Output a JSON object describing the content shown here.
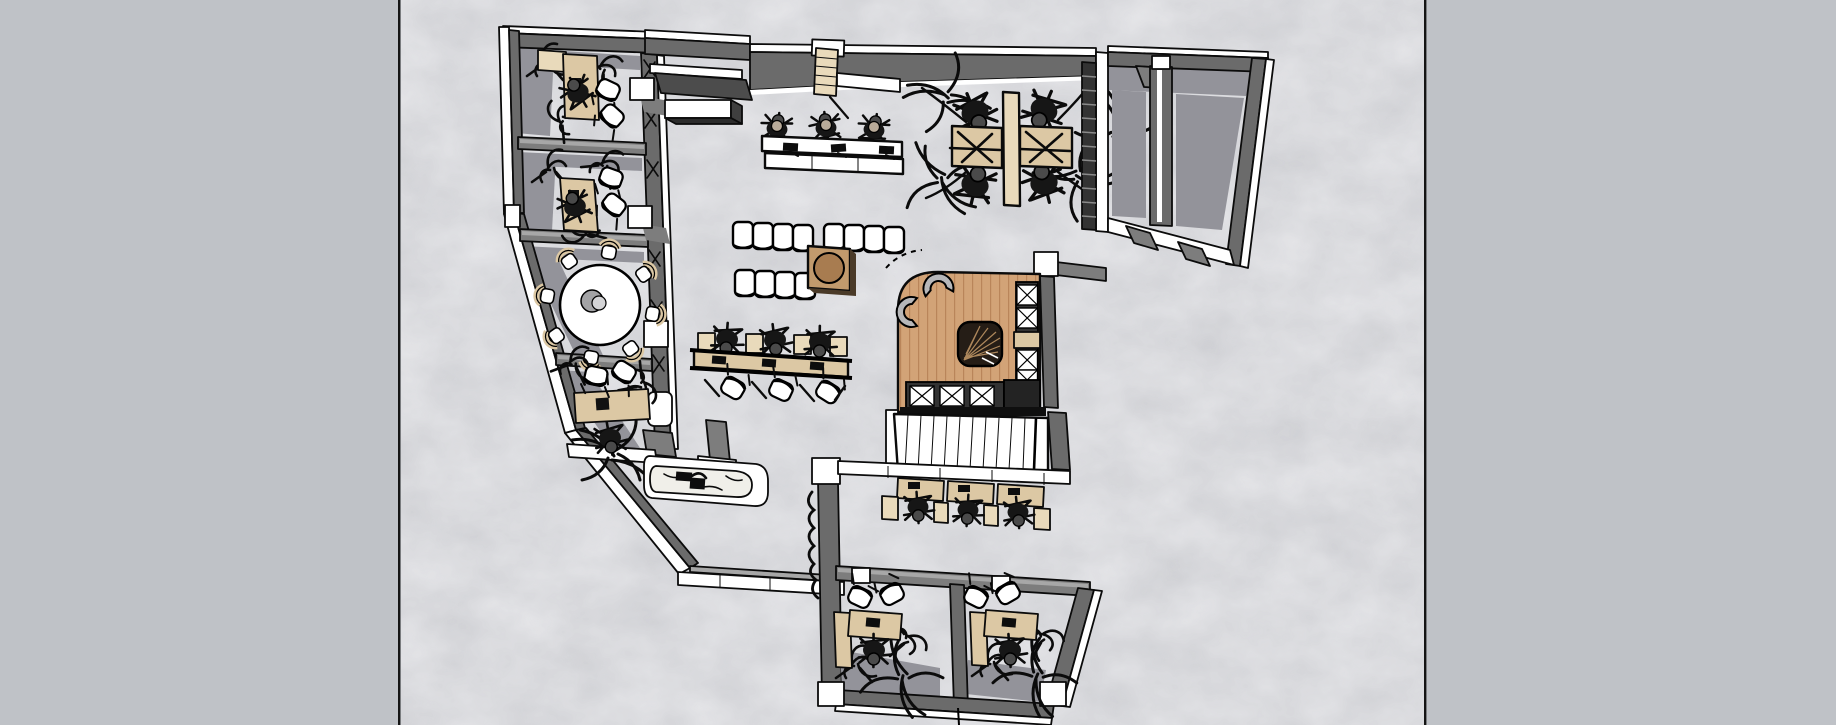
{
  "view": {
    "kind": "architectural-floor-plan",
    "projection": "top-down",
    "visible_text": "none"
  },
  "palette": {
    "margin": "#bfc2c7",
    "canvas_base": "#cdced2",
    "canvas_mottle_light": "#e3e4e7",
    "canvas_mottle_dark": "#b9babf",
    "frame_line": "#141414",
    "ink": "#0b0b0b",
    "wall": "#6b6b6b",
    "wall_mid": "#7d7d7d",
    "wall_top": "#a7a7a7",
    "wall_face": "#ffffff",
    "wall_shadow": "#93939a",
    "wood_floor": "#d2a377",
    "wood_plank": "#b9855a",
    "desk_wood": "#dcc8a4",
    "desk_wood_light": "#e9dabb",
    "table_wood": "#c19a6d",
    "table_top": "#a87c50",
    "counter_marble": "#f0efe9",
    "rug": "#251d16",
    "rug_weave": "#c59a67",
    "chair_gray": "#b7b7b9",
    "chair_cushion": "#b9ab99",
    "shelf_dark": "#333333",
    "seat_white": "#ffffff"
  },
  "scene": {
    "areas": [
      {
        "name": "private-office-top-1",
        "desks": 1,
        "task_chairs": 1,
        "guest_chairs": 2,
        "plants": 3
      },
      {
        "name": "private-office-top-2",
        "desks": 1,
        "task_chairs": 1,
        "guest_chairs": 2,
        "plants": 3
      },
      {
        "name": "round-table-meeting-room",
        "round_tables": 1,
        "chairs": 8,
        "decor_spheres": 1
      },
      {
        "name": "private-office-top-3",
        "desks": 1,
        "task_chairs": 1,
        "guest_chairs": 2,
        "plants": 3
      },
      {
        "name": "kitchenette",
        "counters": 1,
        "sinks": 1
      },
      {
        "name": "entry",
        "step_flights": 1,
        "canopies": 1,
        "credenzas": 1
      },
      {
        "name": "reception-counter",
        "stools": 3,
        "counter_sections": 3
      },
      {
        "name": "waiting-area",
        "white_chairs": 12,
        "coffee_tables": 1
      },
      {
        "name": "open-desk-row",
        "workstations": 3,
        "task_chairs": 3,
        "guest_chairs": 3
      },
      {
        "name": "team-desk-cluster",
        "desks": 4,
        "task_chairs": 8,
        "plants": 4
      },
      {
        "name": "storage-rooms-right",
        "rooms": 2,
        "shelving_units": 1
      },
      {
        "name": "lounge-reception",
        "armchairs": 2,
        "rugs": 1,
        "shelving_runs": 2
      },
      {
        "name": "staircase",
        "flights": 1,
        "treads": 11
      },
      {
        "name": "study-desk-row",
        "desks": 3,
        "task_chairs": 3,
        "cabinets": 4
      },
      {
        "name": "private-office-bottom-left",
        "desks": 1,
        "cabinets": 1,
        "task_chairs": 1,
        "guest_chairs": 2
      },
      {
        "name": "private-office-bottom-right",
        "desks": 1,
        "cabinets": 1,
        "task_chairs": 1,
        "guest_chairs": 2
      }
    ]
  }
}
